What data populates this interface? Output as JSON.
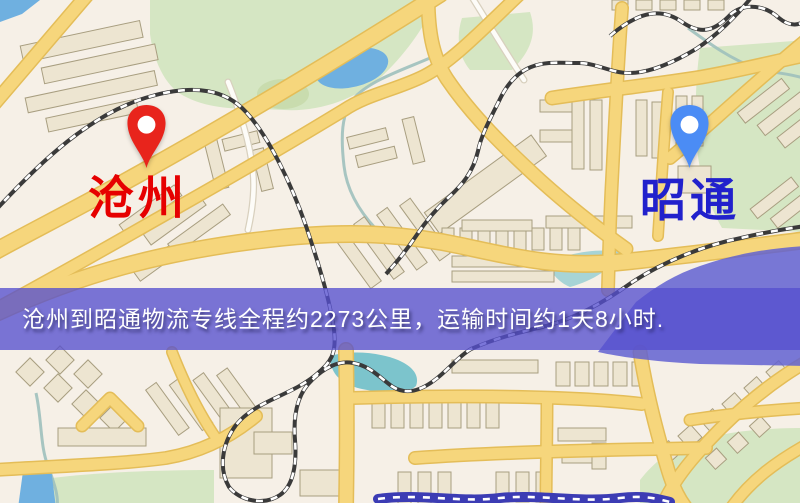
{
  "banner": {
    "text": "沧州到昭通物流专线全程约2273公里，运输时间约1天8小时."
  },
  "origin": {
    "label": "沧州"
  },
  "destination": {
    "label": "昭通"
  },
  "theme": {
    "land": "#f6f0e7",
    "green": "#d5e6c3",
    "green2": "#c9dcae",
    "water": "#6fb0e0",
    "water_teal": "#7cc4cc",
    "water_purple": "#6261d1",
    "road_fill": "#f6d67c",
    "road_casing": "#e4bd58",
    "building_fill": "#ede5d1",
    "building_stroke": "#a89e80",
    "rail_dark": "#3a3a3a",
    "rail_light": "#ffffff",
    "white_road": "#fdfcf8",
    "white_road_casing": "#d8d0be",
    "stream": "#9fc0bc",
    "dark_strip": "#3c3cb4",
    "banner_bg": "rgba(86,80,206,0.78)",
    "banner_text": "#ffffff",
    "origin_marker": "#e8241c",
    "origin_label": "#e60000",
    "dest_marker": "#4b8cf5",
    "dest_label": "#2121cc"
  }
}
